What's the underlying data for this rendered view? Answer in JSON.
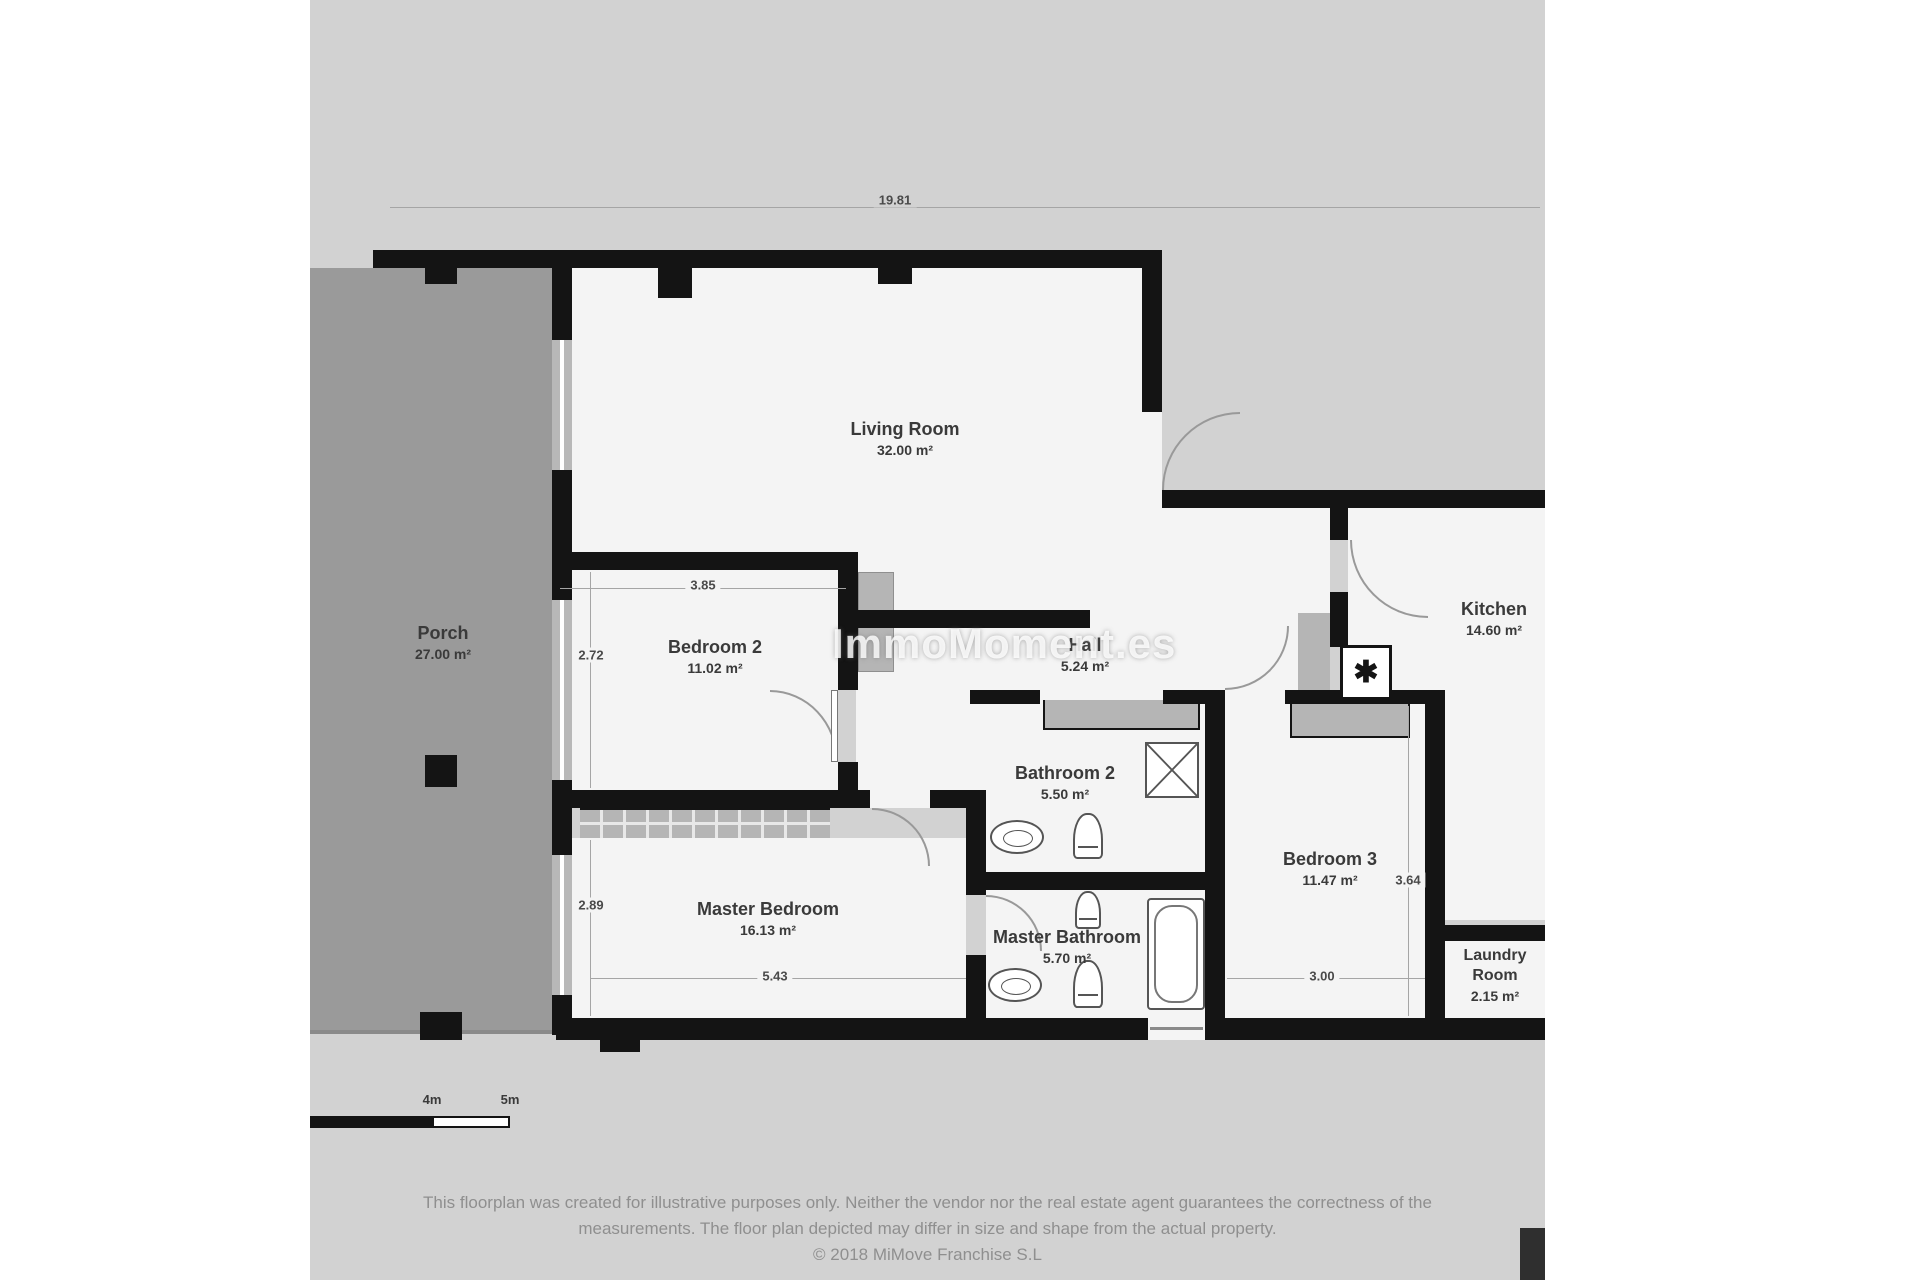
{
  "plan": {
    "background_color": "#d2d2d2",
    "wall_color": "#141414",
    "room_fill": "#f4f4f4",
    "porch_fill": "#9a9a9a",
    "watermark": "ImmoMoment.es",
    "boiler_symbol": "✱",
    "rooms": [
      {
        "id": "living_room",
        "name": "Living Room",
        "area": "32.00 m²"
      },
      {
        "id": "porch",
        "name": "Porch",
        "area": "27.00 m²"
      },
      {
        "id": "bedroom_2",
        "name": "Bedroom 2",
        "area": "11.02 m²"
      },
      {
        "id": "hall",
        "name": "Hall",
        "area": "5.24 m²"
      },
      {
        "id": "kitchen",
        "name": "Kitchen",
        "area": "14.60 m²"
      },
      {
        "id": "bathroom_2",
        "name": "Bathroom 2",
        "area": "5.50 m²"
      },
      {
        "id": "master_bedroom",
        "name": "Master Bedroom",
        "area": "16.13 m²"
      },
      {
        "id": "master_bathroom",
        "name": "Master Bathroom",
        "area": "5.70 m²"
      },
      {
        "id": "bedroom_3",
        "name": "Bedroom 3",
        "area": "11.47 m²"
      },
      {
        "id": "laundry_room",
        "name": "Laundry Room",
        "area": "2.15 m²"
      }
    ],
    "dimensions": {
      "top_width": "19.81",
      "bedroom2_width": "3.85",
      "bedroom2_depth": "2.72",
      "master_depth": "2.89",
      "master_width": "5.43",
      "bedroom3_depth": "3.64",
      "bedroom3_width": "3.00"
    },
    "scale_bar": {
      "label_4m": "4m",
      "label_5m": "5m"
    }
  },
  "footer": {
    "disclaimer_line1": "This floorplan was created for illustrative purposes only. Neither the vendor nor the real estate agent guarantees the correctness of the",
    "disclaimer_line2": "measurements. The floor plan depicted may differ in size and shape from the actual property.",
    "copyright": "© 2018 MiMove Franchise S.L"
  }
}
